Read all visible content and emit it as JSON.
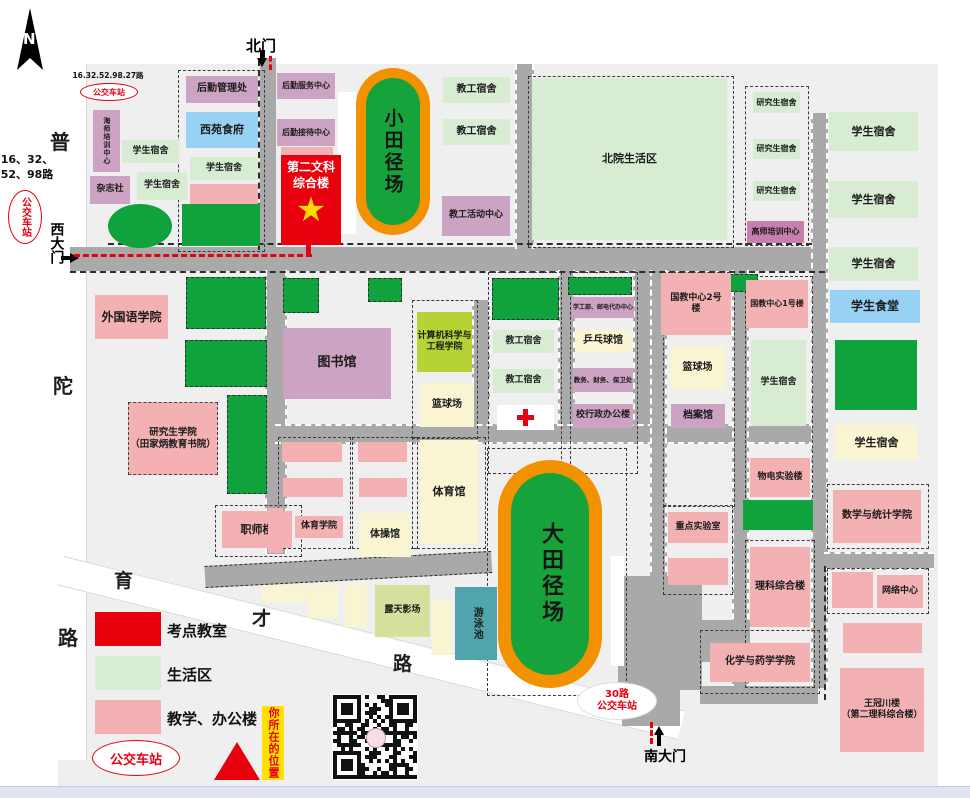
{
  "colors": {
    "exam": "#e8000d",
    "life": "#d8ecd4",
    "teach": "#f4b1b4",
    "admin": "#cda3c4",
    "admin2": "#c87fae",
    "food": "#97d1f4",
    "court": "#f9f5d3",
    "tree": "#10a23c",
    "cs": "#b5d334",
    "openair": "#d4e09c",
    "pool": "#51a4ac",
    "ring": "#f29200",
    "infield": "#16a33c",
    "road": "#a9a9a9",
    "route": "#e60012",
    "you_bg": "#ffe000",
    "white": "#ffffff"
  },
  "compass": {
    "letter": "N"
  },
  "gates": {
    "north": {
      "label": "北门"
    },
    "west": {
      "label": "西大门"
    },
    "south": {
      "label": "南大门"
    }
  },
  "road_names": {
    "putuo": [
      "普",
      "陀",
      "路"
    ],
    "yucai": [
      "育",
      "才",
      "路"
    ]
  },
  "bus_stops": {
    "top_left": {
      "lines": "16.32.52.98.27路",
      "label": "公交车站"
    },
    "west": {
      "lines": [
        "16、32、",
        "52、98路"
      ],
      "label": "公交车站"
    },
    "south": {
      "lines": [
        "30路",
        "公交车站"
      ]
    },
    "legend": {
      "label": "公交车站"
    }
  },
  "tracks": [
    {
      "label": "小田径场"
    },
    {
      "label": "大田径场"
    }
  ],
  "main_building": {
    "label": "第二文科\n综合楼"
  },
  "legend": {
    "items": [
      {
        "c": "exam",
        "label": "考点教室"
      },
      {
        "c": "life",
        "label": "生活区"
      },
      {
        "c": "teach",
        "label": "教学、办公楼"
      }
    ],
    "you_are_here": "你所在的位置"
  },
  "buildings": [
    {
      "n": "logistics-management-office",
      "label": "后勤管理处",
      "x": 186,
      "y": 76,
      "w": 72,
      "h": 27,
      "c": "admin",
      "fs": 10
    },
    {
      "n": "logistics-service-center",
      "label": "后勤服务中心",
      "x": 277,
      "y": 73,
      "w": 58,
      "h": 26,
      "c": "admin",
      "fs": 8
    },
    {
      "n": "xiyuan-dining-hall",
      "label": "西苑食府",
      "x": 186,
      "y": 112,
      "w": 72,
      "h": 36,
      "c": "food",
      "fs": 11
    },
    {
      "n": "logistics-reception-center",
      "label": "后勤接待中心",
      "x": 277,
      "y": 119,
      "w": 58,
      "h": 27,
      "c": "admin",
      "fs": 8
    },
    {
      "n": "haishi-training-center",
      "label": "海师培训中心",
      "x": 93,
      "y": 110,
      "w": 27,
      "h": 62,
      "c": "admin",
      "fs": 7,
      "v": 1
    },
    {
      "n": "student-dormitory",
      "label": "学生宿舍",
      "x": 122,
      "y": 140,
      "w": 57,
      "h": 23,
      "c": "life",
      "fs": 9
    },
    {
      "n": "magazine-office",
      "label": "杂志社",
      "x": 90,
      "y": 176,
      "w": 40,
      "h": 28,
      "c": "admin",
      "fs": 9
    },
    {
      "n": "student-dormitory",
      "label": "学生宿舍",
      "x": 137,
      "y": 172,
      "w": 50,
      "h": 28,
      "c": "life",
      "fs": 9
    },
    {
      "n": "student-dormitory",
      "label": "学生宿舍",
      "x": 190,
      "y": 157,
      "w": 68,
      "h": 23,
      "c": "life",
      "fs": 9
    },
    {
      "n": "map-block",
      "label": "",
      "x": 190,
      "y": 184,
      "w": 68,
      "h": 20,
      "c": "teach"
    },
    {
      "n": "map-block",
      "label": "",
      "x": 281,
      "y": 147,
      "w": 52,
      "h": 9,
      "c": "teach"
    },
    {
      "n": "staff-dormitory",
      "label": "教工宿舍",
      "x": 443,
      "y": 77,
      "w": 67,
      "h": 26,
      "c": "life",
      "fs": 10
    },
    {
      "n": "staff-dormitory",
      "label": "教工宿舍",
      "x": 443,
      "y": 119,
      "w": 67,
      "h": 26,
      "c": "life",
      "fs": 10
    },
    {
      "n": "staff-activity-center",
      "label": "教工活动中心",
      "x": 442,
      "y": 196,
      "w": 68,
      "h": 40,
      "c": "admin",
      "fs": 9
    },
    {
      "n": "north-campus-living-area",
      "label": "北院生活区",
      "x": 532,
      "y": 78,
      "w": 195,
      "h": 162,
      "c": "life",
      "fs": 11
    },
    {
      "n": "graduate-dormitory",
      "label": "研究生宿舍",
      "x": 753,
      "y": 92,
      "w": 47,
      "h": 21,
      "c": "life",
      "fs": 8
    },
    {
      "n": "graduate-dormitory",
      "label": "研究生宿舍",
      "x": 753,
      "y": 139,
      "w": 47,
      "h": 20,
      "c": "life",
      "fs": 8
    },
    {
      "n": "graduate-dormitory",
      "label": "研究生宿舍",
      "x": 753,
      "y": 181,
      "w": 47,
      "h": 20,
      "c": "life",
      "fs": 8
    },
    {
      "n": "gaoshi-training-center",
      "label": "高师培训中心",
      "x": 747,
      "y": 221,
      "w": 57,
      "h": 22,
      "c": "admin2",
      "fs": 8
    },
    {
      "n": "student-dormitory",
      "label": "学生宿舍",
      "x": 829,
      "y": 112,
      "w": 89,
      "h": 39,
      "c": "life",
      "fs": 11
    },
    {
      "n": "student-dormitory",
      "label": "学生宿舍",
      "x": 829,
      "y": 181,
      "w": 89,
      "h": 37,
      "c": "life",
      "fs": 11
    },
    {
      "n": "student-dormitory",
      "label": "学生宿舍",
      "x": 829,
      "y": 247,
      "w": 89,
      "h": 34,
      "c": "life",
      "fs": 11
    },
    {
      "n": "student-canteen",
      "label": "学生食堂",
      "x": 830,
      "y": 290,
      "w": 90,
      "h": 33,
      "c": "food",
      "fs": 12
    },
    {
      "n": "foreign-languages-school",
      "label": "外国语学院",
      "x": 95,
      "y": 295,
      "w": 73,
      "h": 44,
      "c": "teach",
      "fs": 12
    },
    {
      "n": "library",
      "label": "图书馆",
      "x": 283,
      "y": 328,
      "w": 108,
      "h": 71,
      "c": "admin",
      "fs": 13
    },
    {
      "n": "computer-science-school",
      "label": "计算机科学与\n工程学院",
      "x": 417,
      "y": 312,
      "w": 55,
      "h": 60,
      "c": "cs",
      "fs": 9
    },
    {
      "n": "basketball-court",
      "label": "篮球场",
      "x": 420,
      "y": 383,
      "w": 54,
      "h": 44,
      "c": "court",
      "fs": 10
    },
    {
      "n": "staff-dormitory",
      "label": "教工宿舍",
      "x": 493,
      "y": 330,
      "w": 61,
      "h": 23,
      "c": "life",
      "fs": 9
    },
    {
      "n": "staff-dormitory",
      "label": "教工宿舍",
      "x": 493,
      "y": 369,
      "w": 61,
      "h": 24,
      "c": "life",
      "fs": 9
    },
    {
      "n": "clinic",
      "label": "",
      "x": 497,
      "y": 405,
      "w": 57,
      "h": 25,
      "c": "white"
    },
    {
      "n": "student-affairs-postal-center",
      "label": "学工部、邮电代办中心",
      "x": 572,
      "y": 297,
      "w": 62,
      "h": 21,
      "c": "admin",
      "fs": 6
    },
    {
      "n": "table-tennis-gym",
      "label": "乒乓球馆",
      "x": 575,
      "y": 330,
      "w": 56,
      "h": 22,
      "c": "court",
      "fs": 10
    },
    {
      "n": "academic-finance-security-office",
      "label": "教务、财务、保卫处",
      "x": 573,
      "y": 368,
      "w": 60,
      "h": 24,
      "c": "admin",
      "fs": 6.5
    },
    {
      "n": "admin-building",
      "label": "校行政办公楼",
      "x": 573,
      "y": 404,
      "w": 60,
      "h": 24,
      "c": "admin",
      "fs": 9
    },
    {
      "n": "graduate-school",
      "label": "研究生学院\n（田家炳教育书院）",
      "x": 128,
      "y": 402,
      "w": 88,
      "h": 71,
      "c": "teach",
      "fs": 9.5,
      "db": 1
    },
    {
      "n": "zhishi-building",
      "label": "职师楼",
      "x": 222,
      "y": 511,
      "w": 70,
      "h": 37,
      "c": "teach",
      "fs": 11
    },
    {
      "n": "map-block",
      "label": "",
      "x": 282,
      "y": 442,
      "w": 60,
      "h": 20,
      "c": "teach"
    },
    {
      "n": "map-block",
      "label": "",
      "x": 283,
      "y": 478,
      "w": 60,
      "h": 19,
      "c": "teach"
    },
    {
      "n": "map-block",
      "label": "",
      "x": 358,
      "y": 442,
      "w": 49,
      "h": 20,
      "c": "teach"
    },
    {
      "n": "map-block",
      "label": "",
      "x": 359,
      "y": 478,
      "w": 48,
      "h": 19,
      "c": "teach"
    },
    {
      "n": "map-block",
      "label": "",
      "x": 268,
      "y": 508,
      "w": 15,
      "h": 45,
      "c": "teach"
    },
    {
      "n": "pe-school",
      "label": "体育学院",
      "x": 295,
      "y": 516,
      "w": 48,
      "h": 22,
      "c": "teach",
      "fs": 9
    },
    {
      "n": "gymnastics-hall",
      "label": "体操馆",
      "x": 359,
      "y": 513,
      "w": 52,
      "h": 44,
      "c": "court",
      "fs": 10
    },
    {
      "n": "gymnasium",
      "label": "体育馆",
      "x": 420,
      "y": 440,
      "w": 58,
      "h": 104,
      "c": "court",
      "fs": 11
    },
    {
      "n": "intl-edu-center-2",
      "label": "国教中心2号\n楼",
      "x": 661,
      "y": 273,
      "w": 70,
      "h": 62,
      "c": "teach",
      "fs": 9
    },
    {
      "n": "intl-edu-center-1",
      "label": "国教中心1号楼",
      "x": 746,
      "y": 280,
      "w": 62,
      "h": 48,
      "c": "teach",
      "fs": 8
    },
    {
      "n": "basketball-court",
      "label": "篮球场",
      "x": 670,
      "y": 346,
      "w": 55,
      "h": 44,
      "c": "court",
      "fs": 10
    },
    {
      "n": "archives",
      "label": "档案馆",
      "x": 671,
      "y": 404,
      "w": 54,
      "h": 24,
      "c": "admin",
      "fs": 10
    },
    {
      "n": "student-dormitory",
      "label": "学生宿舍",
      "x": 751,
      "y": 340,
      "w": 55,
      "h": 86,
      "c": "life",
      "fs": 9
    },
    {
      "n": "student-dormitory",
      "label": "学生宿舍",
      "x": 835,
      "y": 425,
      "w": 83,
      "h": 35,
      "c": "court",
      "fs": 11
    },
    {
      "n": "physics-lab-building",
      "label": "物电实验楼",
      "x": 750,
      "y": 458,
      "w": 60,
      "h": 39,
      "c": "teach",
      "fs": 9
    },
    {
      "n": "math-statistics-school",
      "label": "数学与统计学院",
      "x": 833,
      "y": 490,
      "w": 88,
      "h": 53,
      "c": "teach",
      "fs": 10
    },
    {
      "n": "key-laboratory",
      "label": "重点实验室",
      "x": 668,
      "y": 512,
      "w": 60,
      "h": 31,
      "c": "teach",
      "fs": 9
    },
    {
      "n": "map-block",
      "label": "",
      "x": 668,
      "y": 558,
      "w": 60,
      "h": 27,
      "c": "teach"
    },
    {
      "n": "science-building",
      "label": "理科综合楼",
      "x": 750,
      "y": 547,
      "w": 60,
      "h": 80,
      "c": "teach",
      "fs": 10
    },
    {
      "n": "network-center",
      "label": "网络中心",
      "x": 877,
      "y": 575,
      "w": 46,
      "h": 33,
      "c": "teach",
      "fs": 9
    },
    {
      "n": "map-block",
      "label": "",
      "x": 832,
      "y": 572,
      "w": 41,
      "h": 36,
      "c": "teach"
    },
    {
      "n": "map-block",
      "label": "",
      "x": 843,
      "y": 623,
      "w": 79,
      "h": 30,
      "c": "teach"
    },
    {
      "n": "chemistry-pharmacy-school",
      "label": "化学与药学学院",
      "x": 710,
      "y": 643,
      "w": 100,
      "h": 39,
      "c": "teach",
      "fs": 10
    },
    {
      "n": "wangguanchuan-building",
      "label": "王冠川楼\n（第二理科综合楼）",
      "x": 840,
      "y": 668,
      "w": 84,
      "h": 84,
      "c": "teach",
      "fs": 9
    },
    {
      "n": "open-air-cinema",
      "label": "露天影场",
      "x": 375,
      "y": 585,
      "w": 55,
      "h": 52,
      "c": "openair",
      "fs": 9
    },
    {
      "n": "swimming-pool",
      "label": "游泳池",
      "x": 455,
      "y": 587,
      "w": 42,
      "h": 73,
      "c": "pool",
      "fs": 10,
      "v": 1
    },
    {
      "n": "map-block",
      "label": "",
      "x": 262,
      "y": 585,
      "w": 45,
      "h": 17,
      "c": "court"
    },
    {
      "n": "map-block",
      "label": "",
      "x": 308,
      "y": 585,
      "w": 30,
      "h": 33,
      "c": "court"
    },
    {
      "n": "map-block",
      "label": "",
      "x": 345,
      "y": 583,
      "w": 22,
      "h": 44,
      "c": "court"
    },
    {
      "n": "map-block",
      "label": "",
      "x": 432,
      "y": 600,
      "w": 20,
      "h": 55,
      "c": "court"
    }
  ],
  "greens": [
    [
      108,
      204,
      64,
      44,
      1,
      0
    ],
    [
      182,
      204,
      78,
      42,
      0,
      0
    ],
    [
      186,
      277,
      78,
      50,
      0,
      1
    ],
    [
      283,
      278,
      34,
      33,
      0,
      1
    ],
    [
      368,
      278,
      32,
      22,
      0,
      1
    ],
    [
      492,
      278,
      65,
      40,
      0,
      1
    ],
    [
      568,
      277,
      62,
      16,
      0,
      1
    ],
    [
      700,
      274,
      56,
      16,
      0,
      1
    ],
    [
      185,
      340,
      80,
      45,
      0,
      1
    ],
    [
      227,
      395,
      38,
      97,
      0,
      1
    ],
    [
      743,
      500,
      70,
      30,
      0,
      0
    ],
    [
      835,
      340,
      82,
      70,
      0,
      0
    ]
  ],
  "whites": [
    [
      338,
      92,
      18,
      142
    ],
    [
      611,
      556,
      13,
      110
    ]
  ],
  "roads": [
    [
      70,
      247,
      755,
      24,
      0
    ],
    [
      260,
      58,
      16,
      192,
      0
    ],
    [
      515,
      64,
      15,
      185,
      1
    ],
    [
      265,
      270,
      18,
      284,
      1
    ],
    [
      472,
      300,
      14,
      132,
      1
    ],
    [
      558,
      270,
      13,
      160,
      1
    ],
    [
      633,
      270,
      15,
      160,
      1
    ],
    [
      275,
      424,
      550,
      16,
      2
    ],
    [
      650,
      270,
      13,
      312,
      1
    ],
    [
      732,
      270,
      13,
      420,
      1
    ],
    [
      811,
      113,
      13,
      575,
      1
    ],
    [
      824,
      552,
      110,
      14,
      2
    ],
    [
      618,
      576,
      84,
      114,
      0
    ],
    [
      622,
      688,
      58,
      38,
      0
    ],
    [
      650,
      620,
      100,
      42,
      0
    ],
    [
      700,
      686,
      118,
      18,
      0
    ]
  ],
  "dashed_blocks": [
    [
      178,
      70,
      85,
      180
    ],
    [
      528,
      76,
      204,
      170
    ],
    [
      745,
      86,
      62,
      158
    ],
    [
      412,
      300,
      64,
      137
    ],
    [
      488,
      272,
      72,
      200
    ],
    [
      570,
      272,
      66,
      200
    ],
    [
      663,
      272,
      70,
      233
    ],
    [
      745,
      276,
      66,
      230
    ],
    [
      278,
      437,
      71,
      110
    ],
    [
      352,
      437,
      64,
      110
    ],
    [
      215,
      505,
      85,
      50
    ],
    [
      412,
      437,
      72,
      110
    ],
    [
      663,
      505,
      68,
      88
    ],
    [
      745,
      540,
      68,
      146
    ],
    [
      700,
      630,
      118,
      62
    ],
    [
      827,
      484,
      100,
      63
    ],
    [
      827,
      568,
      100,
      44
    ],
    [
      487,
      448,
      138,
      246
    ]
  ],
  "dash_lines": [
    [
      108,
      243,
      704,
      "h"
    ],
    [
      70,
      271,
      755,
      "h"
    ],
    [
      824,
      566,
      134,
      "v"
    ],
    [
      258,
      60,
      190,
      "v"
    ]
  ]
}
